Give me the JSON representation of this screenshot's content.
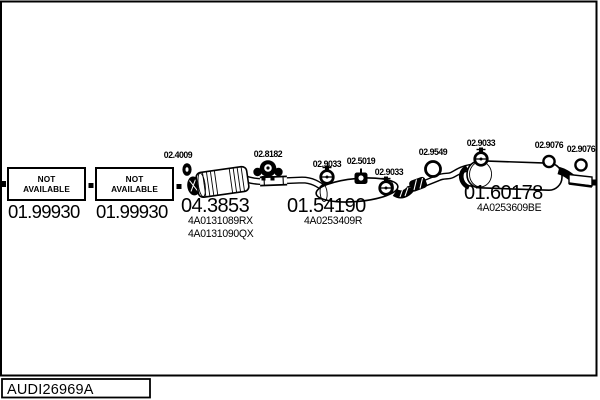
{
  "colors": {
    "ink": "#000000",
    "paper": "#ffffff"
  },
  "footer": {
    "drawing_number": "AUDI26969A"
  },
  "unavailable_boxes": [
    {
      "status_lines": [
        "NOT",
        "AVAILABLE"
      ],
      "part_number": "01.99930"
    },
    {
      "status_lines": [
        "NOT",
        "AVAILABLE"
      ],
      "part_number": "01.99930"
    }
  ],
  "components": {
    "catalyst": {
      "part_number": "04.3853",
      "oem_refs": [
        "4A0131089RX",
        "4A0131090QX"
      ]
    },
    "center_muffler": {
      "part_number": "01.54190",
      "oem_refs": [
        "4A0253409R"
      ]
    },
    "rear_muffler": {
      "part_number": "01.60178",
      "oem_refs": [
        "4A0253609BE"
      ]
    }
  },
  "fittings": [
    {
      "part_number": "02.4009",
      "type": "gasket"
    },
    {
      "part_number": "02.8182",
      "type": "rubber-hanger"
    },
    {
      "part_number": "02.9033",
      "type": "clamp"
    },
    {
      "part_number": "02.5019",
      "type": "rubber-hanger"
    },
    {
      "part_number": "02.9033",
      "type": "clamp"
    },
    {
      "part_number": "02.9549",
      "type": "o-ring"
    },
    {
      "part_number": "02.9033",
      "type": "clamp"
    },
    {
      "part_number": "02.9076",
      "type": "o-ring"
    },
    {
      "part_number": "02.9076",
      "type": "o-ring"
    }
  ]
}
